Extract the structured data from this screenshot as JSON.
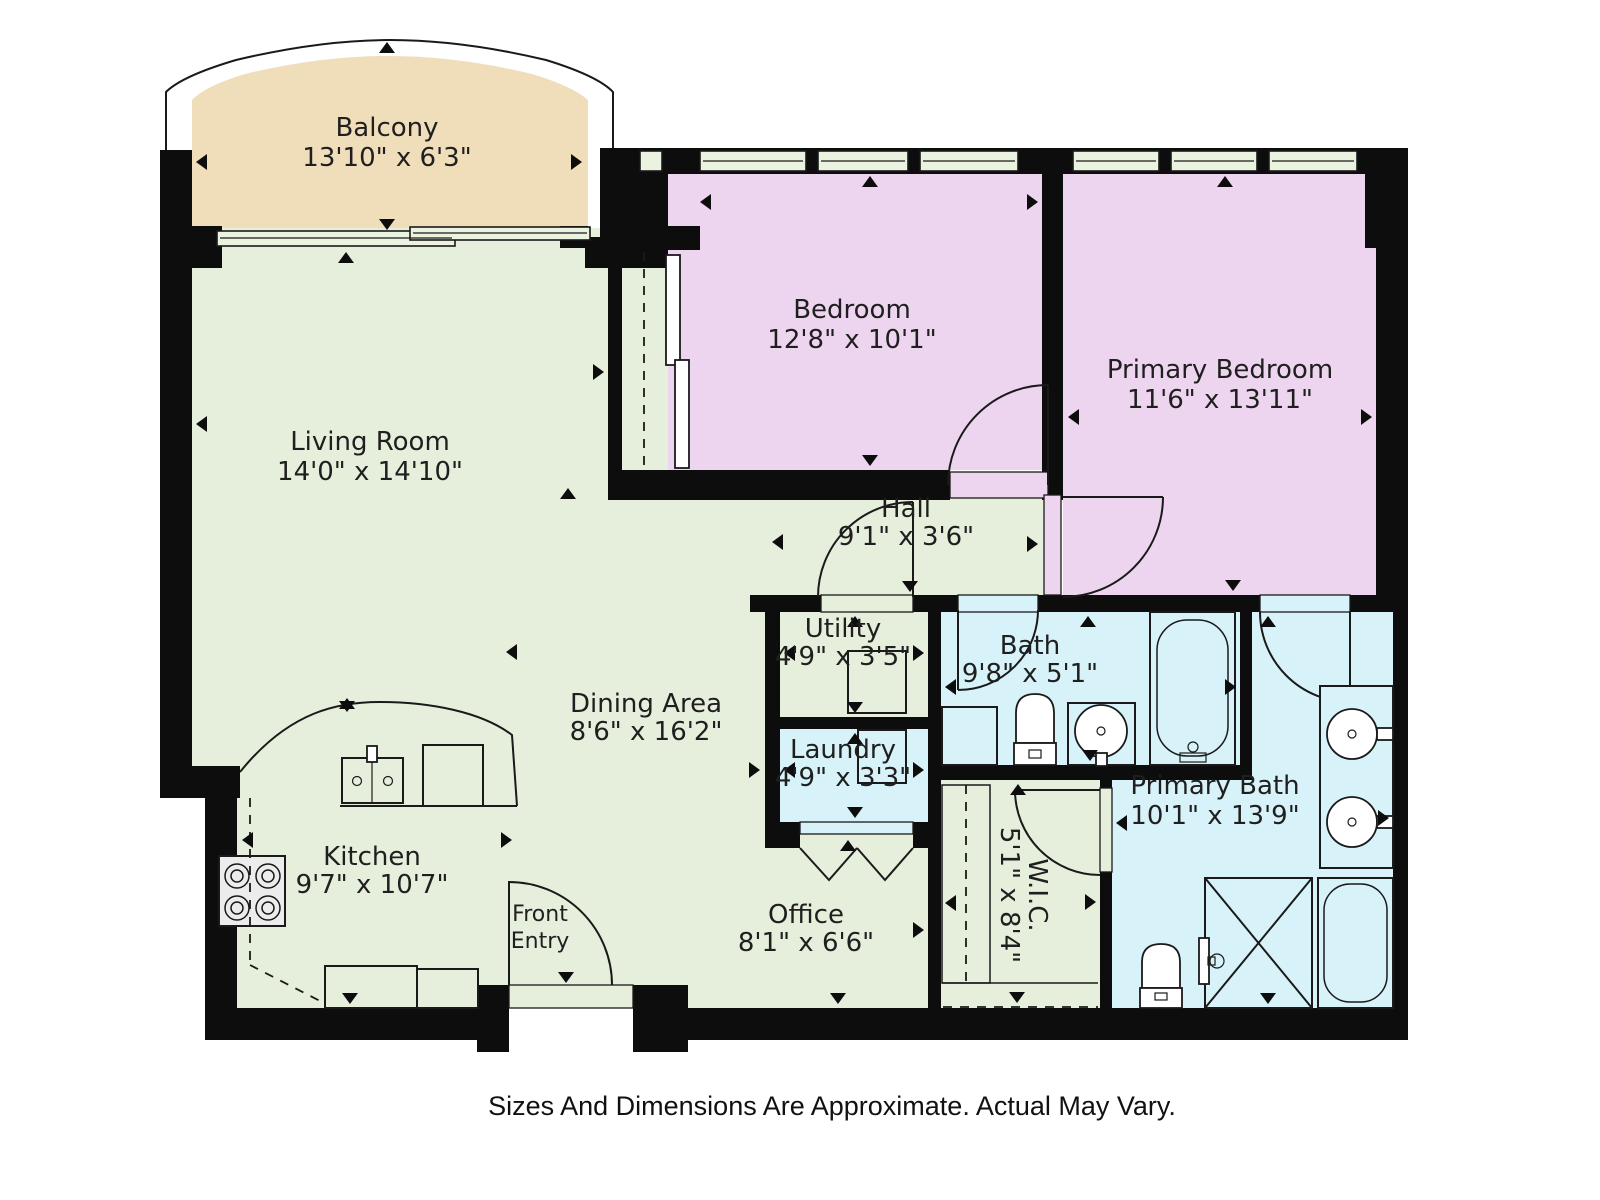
{
  "caption": "Sizes And Dimensions Are Approximate. Actual May Vary.",
  "colors": {
    "room_green": "#e6efdb",
    "room_pink": "#eed5ef",
    "room_blue": "#d7f3f9",
    "balcony_tan": "#f0ddba",
    "wall_black": "#0d0d0d",
    "label_text": "#1f1f1f"
  },
  "rooms": {
    "balcony": {
      "name": "Balcony",
      "dims": "13'10\" x 6'3\""
    },
    "living_room": {
      "name": "Living Room",
      "dims": "14'0\" x 14'10\""
    },
    "bedroom": {
      "name": "Bedroom",
      "dims": "12'8\" x 10'1\""
    },
    "primary_bedroom": {
      "name": "Primary Bedroom",
      "dims": "11'6\" x 13'11\""
    },
    "hall": {
      "name": "Hall",
      "dims": "9'1\" x 3'6\""
    },
    "utility": {
      "name": "Utility",
      "dims": "4'9\" x 3'5\""
    },
    "laundry": {
      "name": "Laundry",
      "dims": "4'9\" x 3'3\""
    },
    "bath": {
      "name": "Bath",
      "dims": "9'8\" x 5'1\""
    },
    "primary_bath": {
      "name": "Primary Bath",
      "dims": "10'1\" x 13'9\""
    },
    "wic": {
      "name": "W.I.C.",
      "dims": "5'1\" x 8'4\""
    },
    "dining_area": {
      "name": "Dining Area",
      "dims": "8'6\" x 16'2\""
    },
    "kitchen": {
      "name": "Kitchen",
      "dims": "9'7\" x 10'7\""
    },
    "office": {
      "name": "Office",
      "dims": "8'1\" x 6'6\""
    },
    "front_entry": {
      "line1": "Front",
      "line2": "Entry"
    }
  }
}
